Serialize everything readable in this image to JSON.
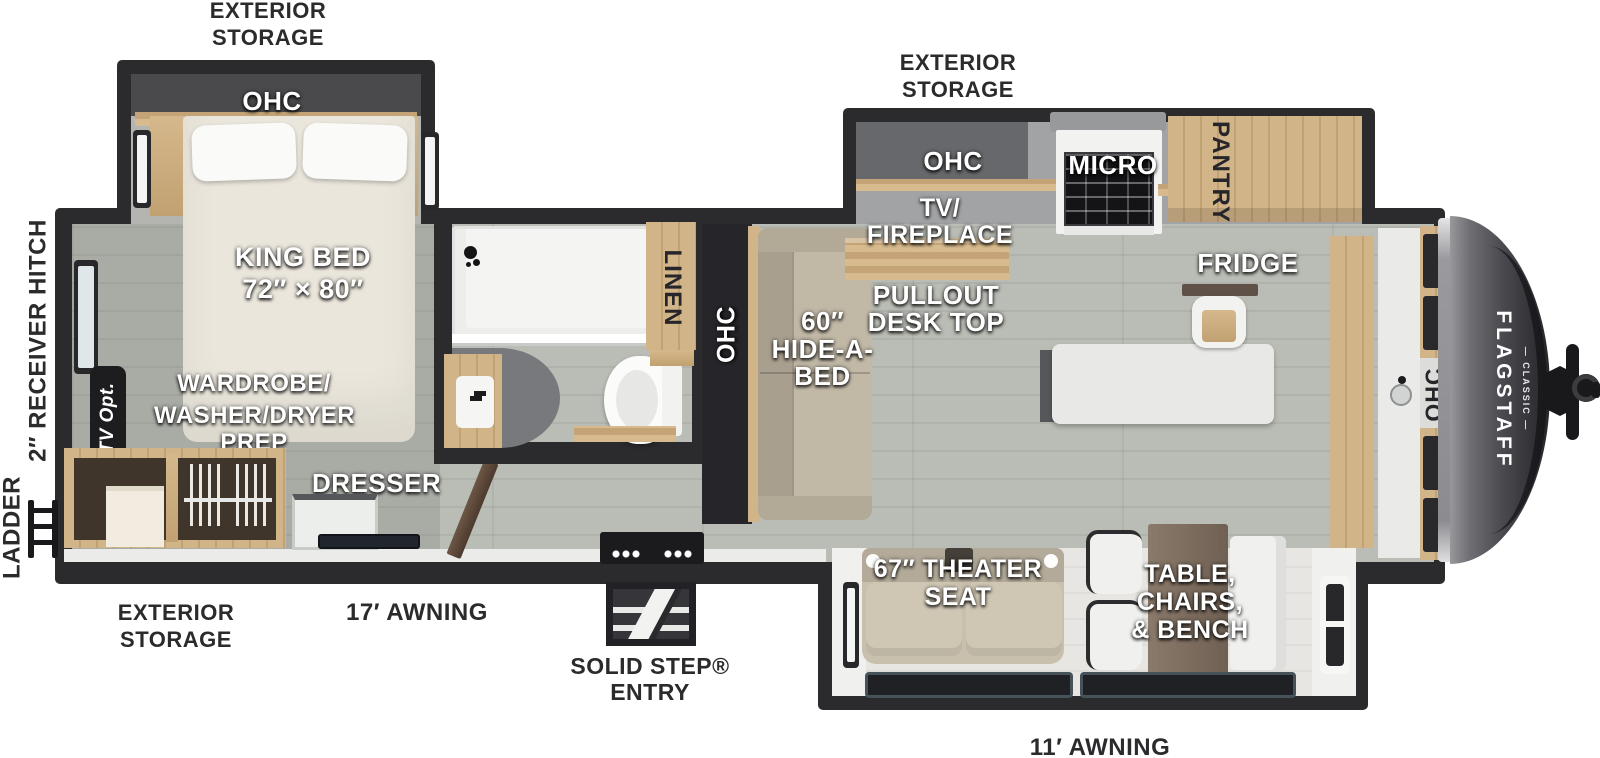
{
  "brand": {
    "name": "FLAGSTAFF",
    "sub": "— CLASSIC —"
  },
  "exterior": {
    "storage_top_left": [
      "EXTERIOR",
      "STORAGE"
    ],
    "storage_top_right": [
      "EXTERIOR",
      "STORAGE"
    ],
    "storage_bottom_left": [
      "EXTERIOR",
      "STORAGE"
    ],
    "awning_left": "17′ AWNING",
    "awning_right": "11′ AWNING",
    "entry": [
      "SOLID STEP®",
      "ENTRY"
    ],
    "ladder": "LADDER",
    "receiver_hitch": "2″ RECEIVER HITCH"
  },
  "bedroom": {
    "ohc": "OHC",
    "king_bed": [
      "KING BED",
      "72″ × 80″"
    ],
    "wardrobe": [
      "WARDROBE/",
      "WASHER/DRYER",
      "PREP"
    ],
    "tv_opt": "TV Opt.",
    "dresser": "DRESSER"
  },
  "bath": {
    "linen": "LINEN"
  },
  "hall": {
    "ohc": "OHC",
    "hide_a_bed": [
      "60″",
      "HIDE-A-",
      "BED"
    ]
  },
  "living": {
    "tv_fireplace": [
      "TV/",
      "FIREPLACE"
    ],
    "desk": [
      "PULLOUT",
      "DESK TOP"
    ],
    "theater": [
      "67″ THEATER",
      "SEAT"
    ],
    "dinette": [
      "TABLE,",
      "CHAIRS,",
      "& BENCH"
    ]
  },
  "kitchen": {
    "ohc": "OHC",
    "micro": "MICRO",
    "pantry": "PANTRY",
    "fridge": "FRIDGE",
    "front_ohc": "OHC"
  },
  "colors": {
    "wall": "#2b2b2e",
    "floor": "#b6b9b1",
    "wood": "#cbae80",
    "cream_bed": "#eae6dc",
    "sofa_beige": "#c8bfad",
    "counter": "#e9e9e7",
    "front_cap": "#46464b"
  }
}
